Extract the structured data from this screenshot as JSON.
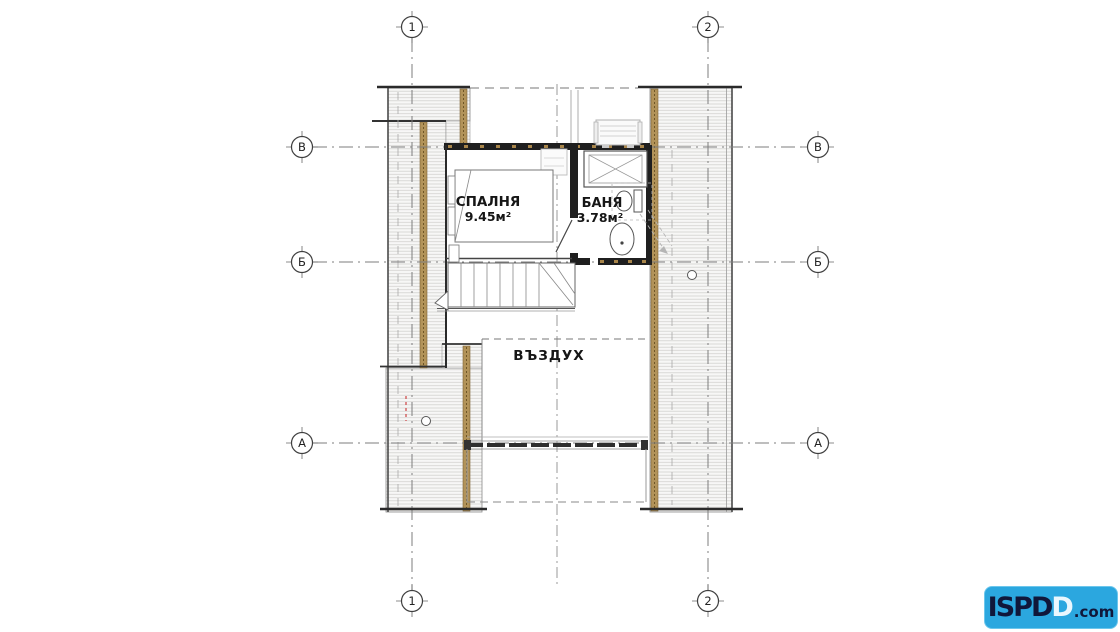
{
  "axes": {
    "top": [
      "1",
      "2"
    ],
    "bottom": [
      "1",
      "2"
    ],
    "left": [
      "В",
      "Б",
      "А"
    ],
    "right": [
      "В",
      "Б",
      "А"
    ]
  },
  "rooms": {
    "bedroom": {
      "name": "СПАЛНЯ",
      "area": "9.45м²"
    },
    "bathroom": {
      "name": "БАНЯ",
      "area": "3.78м²"
    },
    "void": {
      "name": "ВЪЗДУХ"
    }
  },
  "logo": {
    "part_solid": "ISPD",
    "part_outline": "D",
    "part_suffix": ".com",
    "background": "#2ba7df"
  },
  "colors": {
    "wall": "#1f1f1f",
    "insulation": "#b29359",
    "hatch_line": "#d2d1ce",
    "grid": "#7d7d7d",
    "marker_red": "#d05050",
    "logo_text": "#10173a"
  }
}
